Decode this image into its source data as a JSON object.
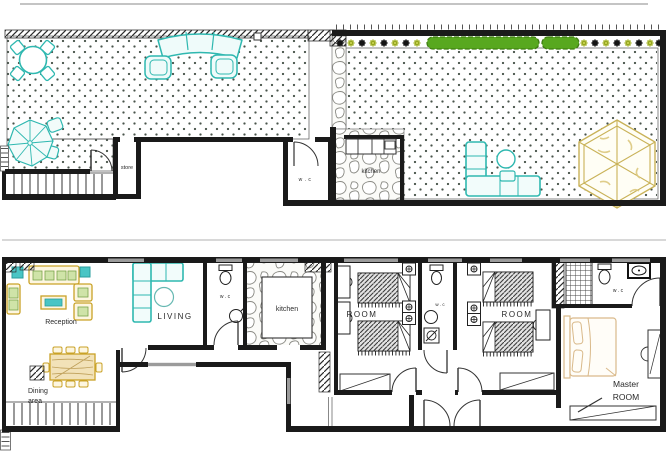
{
  "document": {
    "type": "architectural-floor-plans",
    "sheets": [
      "roof-terrace-plan",
      "main-floor-plan"
    ]
  },
  "colors": {
    "teal_furniture": "#2fb8b0",
    "wood_yellow": "#d9a93c",
    "hedge_green": "#58a81f",
    "flower_green": "#b9c832",
    "wall_black": "#1a1a1a",
    "master_bed_tan": "#d9b98a",
    "gazebo_tan": "#c9b258",
    "window_gray": "#9b9b9b"
  },
  "upper_plan": {
    "labels": {
      "store": "store",
      "wc": "w . c",
      "kitchen": "kitchen"
    }
  },
  "lower_plan": {
    "labels": {
      "reception": "Reception",
      "living": "LIVING",
      "wc_main": "w . c",
      "kitchen": "kitchen",
      "dining_1": "Dining",
      "dining_2": "area",
      "room_left": "ROOM",
      "wc_rooms": "w . c",
      "room_right": "ROOM",
      "wc_master": "w . c",
      "master_1": "Master",
      "master_2": "ROOM"
    }
  }
}
